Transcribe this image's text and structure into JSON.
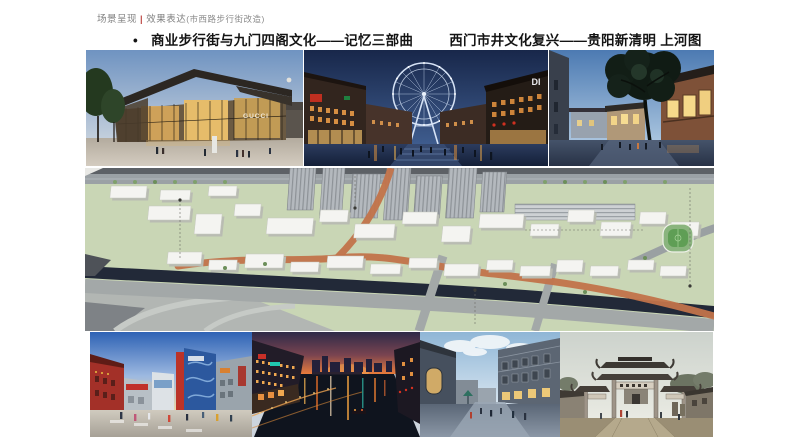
{
  "header": {
    "title": "场景呈现",
    "divider": "|",
    "subtitle": "效果表达",
    "note": "(市西路步行街改造)"
  },
  "bullet": {
    "marker": "•",
    "text_left": "商业步行街与九门四阁文化——记忆三部曲",
    "text_right": "西门市井文化复兴——贵阳新清明 上河图"
  },
  "gallery": {
    "top": [
      {
        "name": "glass-retail-pavilion-dusk",
        "signage": "GUCCI"
      },
      {
        "name": "ferris-wheel-night-plaza",
        "signage": "DI"
      },
      {
        "name": "old-street-big-tree-dusk",
        "signage": ""
      }
    ],
    "masterplan": {
      "name": "aerial-3d-masterplan"
    },
    "bottom": [
      {
        "name": "modern-colorful-street-day"
      },
      {
        "name": "canal-night-view"
      },
      {
        "name": "grey-brick-historic-street-day"
      },
      {
        "name": "memorial-archway-gate"
      }
    ]
  },
  "colors": {
    "header_text": "#808080",
    "header_divider": "#c0504d",
    "bullet_text": "#141414",
    "masterplan_green": "#c9d6b5",
    "masterplan_route_orange": "#c2734a",
    "masterplan_river": "#222938"
  }
}
